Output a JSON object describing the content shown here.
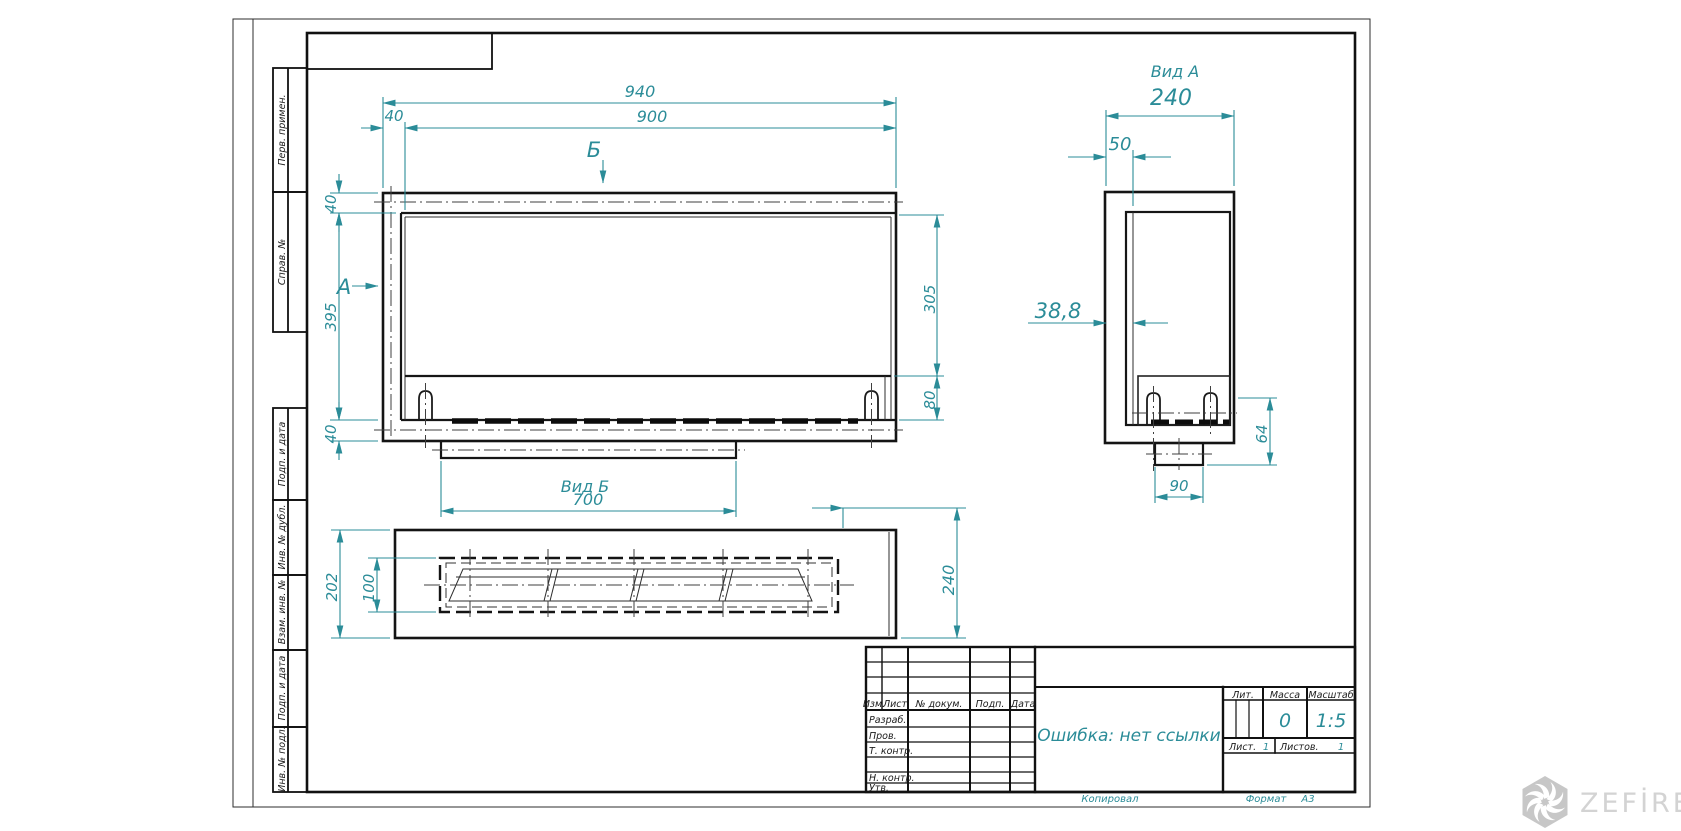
{
  "sheet": {
    "side_strip": {
      "items": [
        {
          "label": "Перв. примен."
        },
        {
          "label": "Справ. №"
        },
        {
          "label": "Подп. и дата"
        },
        {
          "label": "Инв. № дубл."
        },
        {
          "label": "Взам. инв. №"
        },
        {
          "label": "Подп. и дата"
        },
        {
          "label": "Инв. № подл."
        }
      ]
    }
  },
  "views": {
    "front": {
      "section_label_a": "А",
      "section_label_b": "Б"
    },
    "view_a": {
      "title": "Вид А"
    },
    "view_b": {
      "title": "Вид Б"
    }
  },
  "dims": {
    "front": {
      "total_width": "940",
      "inner_width": "900",
      "flange_offset": "40",
      "top_flange": "40",
      "body_height": "395",
      "bottom_flange": "40",
      "window_height": "305",
      "lower_height": "80",
      "opening_width": "700"
    },
    "view_a": {
      "overall_depth": "240",
      "front_offset": "50",
      "wall_thickness": "38,8",
      "duct_width": "90",
      "duct_height": "64"
    },
    "view_b": {
      "overall_depth": "202",
      "slot_depth": "100",
      "overall_height": "240"
    }
  },
  "title_block": {
    "doc_name": "Ошибка: нет ссылки",
    "header_cols": {
      "izm": "Изм.",
      "list": "Лист",
      "ndokum": "№ докум.",
      "podp": "Подп.",
      "data": "Дата"
    },
    "sign_rows": {
      "razrab": "Разраб.",
      "prov": "Пров.",
      "tkontr": "Т. контр.",
      "nkontr": "Н. контр.",
      "utv": "Утв."
    },
    "props": {
      "lit_label": "Лит.",
      "massa_label": "Масса",
      "masshtab_label": "Масштаб",
      "massa_value": "0",
      "scale_value": "1:5",
      "list_label": "Лист.",
      "list_value": "1",
      "listov_label": "Листов.",
      "listov_value": "1"
    },
    "footer": {
      "kopiroval": "Копировал",
      "format_label": "Формат",
      "format_value": "А3"
    }
  },
  "watermark": {
    "brand": "ZEFİRE",
    "logo_icon": "hexagon-flame-icon"
  },
  "colors": {
    "dim_teal": "#2B8C98",
    "line_dark": "#1B1B1B"
  }
}
